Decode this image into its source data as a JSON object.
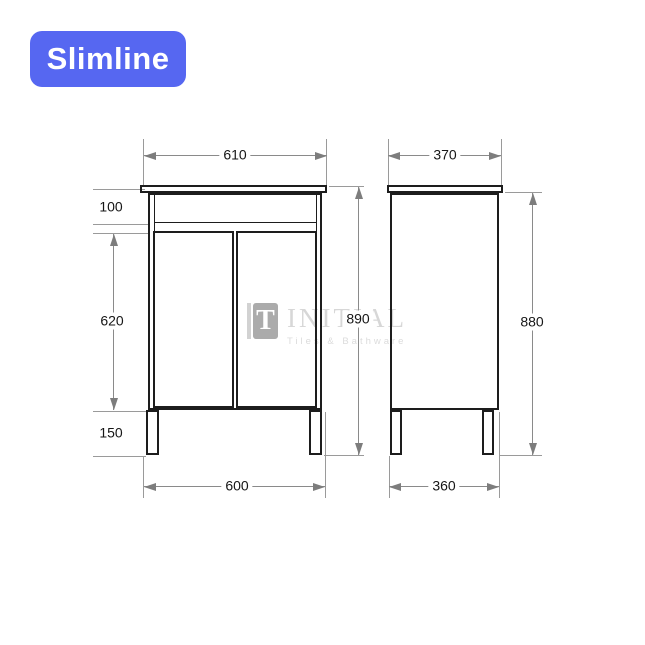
{
  "badge": {
    "label": "Slimline"
  },
  "colors": {
    "badge_bg": "#5667F1",
    "line": "#1d1d1d",
    "dim": "#8a8a8a",
    "wm": "#d7d7d7"
  },
  "watermark": {
    "logo_glyph": "T",
    "brand": "INITIAL",
    "tagline": "Tiles & Bathware"
  },
  "drawing": {
    "front_view": {
      "width_top_mm": "610",
      "apron_height_mm": "100",
      "door_height_mm": "620",
      "leg_height_mm": "150",
      "overall_height_mm": "890",
      "width_bottom_mm": "600"
    },
    "side_view": {
      "depth_top_mm": "370",
      "overall_height_mm": "880",
      "depth_bottom_mm": "360"
    }
  }
}
